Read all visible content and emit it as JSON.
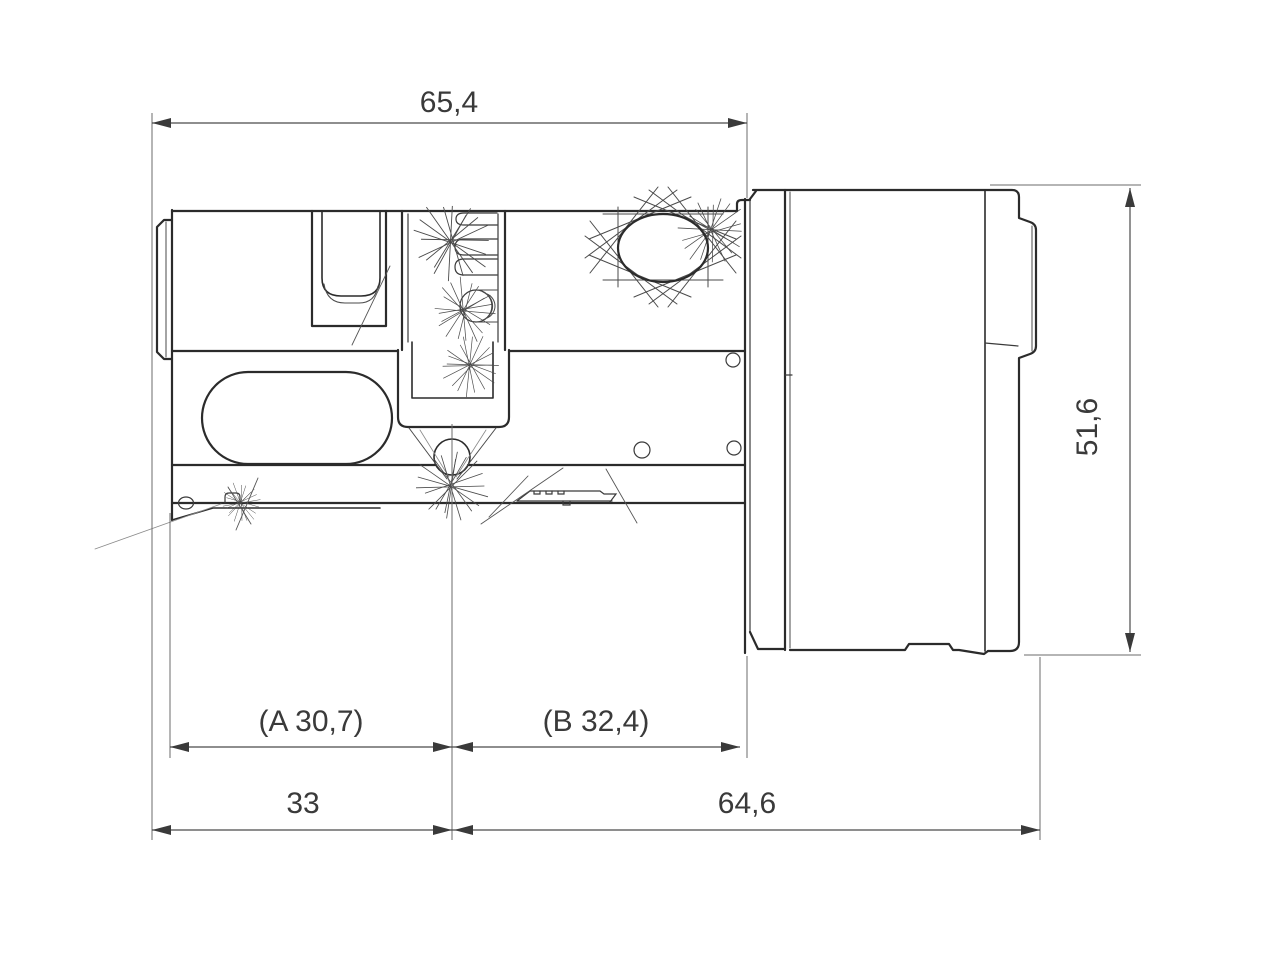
{
  "figure": {
    "type": "technical-dimension-drawing",
    "subject": "digital locking cylinder, side view (profile cylinder with electronic thumb-turn knob)",
    "units": "mm",
    "decimal_separator": ",",
    "background_color": "#ffffff",
    "line_color": "#2b2b2b",
    "dimension_color": "#3a3a3a"
  },
  "dimensions": {
    "overall_top": "65,4",
    "inner_a": "(A 30,7)",
    "inner_b": "(B 32,4)",
    "bottom_left": "33",
    "bottom_right": "64,6",
    "knob_height": "51,6"
  }
}
